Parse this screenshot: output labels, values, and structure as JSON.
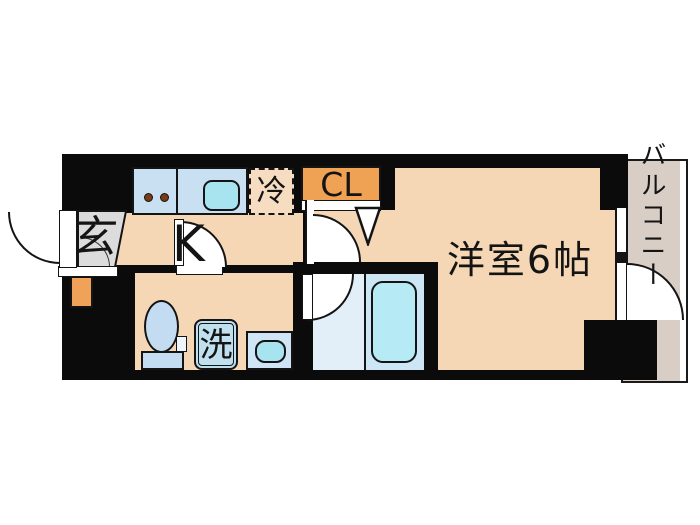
{
  "floorplan": {
    "type": "1K apartment floor plan",
    "labels": {
      "entrance": "玄",
      "kitchen": "K",
      "refrigerator": "冷",
      "closet": "CL",
      "western_room": "洋室6帖",
      "washer": "洗",
      "balcony": "バルコニー"
    },
    "fixtures": [
      "entrance-door",
      "shoe-box",
      "kitchen-counter",
      "stove-burners",
      "kitchen-sink",
      "refrigerator-space",
      "closet",
      "closet-door-marker",
      "room-door",
      "kitchen-door",
      "toilet",
      "washing-machine",
      "wash-basin",
      "bathtub",
      "bath-door",
      "balcony-window",
      "balcony-door"
    ],
    "colors": {
      "wall": "#0b0b0b",
      "floor_peach": "#f5d7b5",
      "entrance_gray": "#dcdcdc",
      "counter_blue": "#c9e0f3",
      "sink_cyan": "#a8e4f0",
      "fridge_fill": "#f6dcc0",
      "closet_orange": "#f0a254",
      "shoebox_orange": "#f0a258",
      "fixture_blue": "#c3dcf2",
      "bath_floor": "#e2eff9",
      "tub_section": "#cde6f6",
      "tub_fill": "#b6ebf5",
      "balcony_gray": "#d8cec6"
    }
  }
}
